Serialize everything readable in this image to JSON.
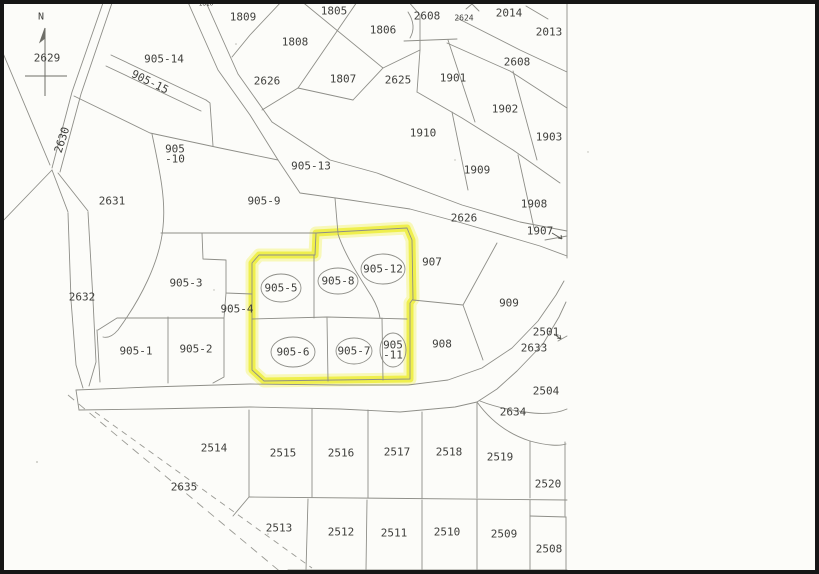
{
  "window": {
    "width": 819,
    "height": 574,
    "kind": "scanned cadastral parcel map"
  },
  "map": {
    "compass": {
      "label": "N"
    },
    "colors": {
      "paper": "#fcfcf9",
      "boundary_line": "#8e8e88",
      "label_text": "#3f3f3c",
      "highlight_yellow": "#eeee35",
      "frame_black": "#161616"
    },
    "highlighted_parcels": [
      "905-5",
      "905-6",
      "905-7",
      "905-8",
      "905-11",
      "905-12"
    ],
    "road_labels": [
      "2626",
      "2630",
      "2633",
      "2608",
      "2635"
    ],
    "labels": [
      {
        "t": "N",
        "x": 41,
        "y": 17,
        "fs": 10
      },
      {
        "t": "2629",
        "x": 47,
        "y": 58
      },
      {
        "t": "905-14",
        "x": 164,
        "y": 59
      },
      {
        "t": "905-15",
        "x": 150,
        "y": 82,
        "rot": 26
      },
      {
        "t": "2630",
        "x": 62,
        "y": 140,
        "rot": -72
      },
      {
        "t": "1810",
        "x": 206,
        "y": 4,
        "fs": 6
      },
      {
        "t": "1809",
        "x": 243,
        "y": 17
      },
      {
        "t": "1805",
        "x": 334,
        "y": 11
      },
      {
        "t": "1808",
        "x": 295,
        "y": 42
      },
      {
        "t": "1806",
        "x": 383,
        "y": 30
      },
      {
        "t": "1807",
        "x": 343,
        "y": 79
      },
      {
        "t": "2626",
        "x": 267,
        "y": 81
      },
      {
        "t": "2625",
        "x": 398,
        "y": 80
      },
      {
        "t": "2608",
        "x": 427,
        "y": 16
      },
      {
        "t": "2624",
        "x": 464,
        "y": 18,
        "fs": 8
      },
      {
        "t": "2014",
        "x": 509,
        "y": 13
      },
      {
        "t": "2013",
        "x": 549,
        "y": 32
      },
      {
        "t": "2608",
        "x": 517,
        "y": 62
      },
      {
        "t": "1901",
        "x": 453,
        "y": 78
      },
      {
        "t": "1902",
        "x": 505,
        "y": 109
      },
      {
        "t": "1910",
        "x": 423,
        "y": 133
      },
      {
        "t": "1903",
        "x": 549,
        "y": 137
      },
      {
        "t": "905-13",
        "x": 311,
        "y": 166
      },
      {
        "t": "1909",
        "x": 477,
        "y": 170
      },
      {
        "t": "905-10",
        "x": 175,
        "y": 154,
        "lines": [
          "905",
          "-10"
        ]
      },
      {
        "t": "905-9",
        "x": 264,
        "y": 201
      },
      {
        "t": "1908",
        "x": 534,
        "y": 204
      },
      {
        "t": "2626",
        "x": 464,
        "y": 218
      },
      {
        "t": "1907",
        "x": 540,
        "y": 231,
        "arrow": [
          552,
          233,
          562,
          239
        ]
      },
      {
        "t": "2631",
        "x": 112,
        "y": 201
      },
      {
        "t": "907",
        "x": 432,
        "y": 262
      },
      {
        "t": "2632",
        "x": 82,
        "y": 297
      },
      {
        "t": "905-3",
        "x": 186,
        "y": 283
      },
      {
        "t": "905-4",
        "x": 237,
        "y": 309
      },
      {
        "t": "909",
        "x": 509,
        "y": 303
      },
      {
        "t": "905-5",
        "x": 281,
        "y": 288,
        "ell": [
          20,
          14
        ]
      },
      {
        "t": "905-8",
        "x": 338,
        "y": 281,
        "ell": [
          20,
          13
        ]
      },
      {
        "t": "905-12",
        "x": 383,
        "y": 269,
        "ell": [
          22,
          15
        ]
      },
      {
        "t": "905-1",
        "x": 136,
        "y": 351
      },
      {
        "t": "905-2",
        "x": 196,
        "y": 349
      },
      {
        "t": "905-6",
        "x": 293,
        "y": 352,
        "ell": [
          22,
          15
        ]
      },
      {
        "t": "905-7",
        "x": 354,
        "y": 351,
        "ell": [
          18,
          13
        ]
      },
      {
        "t": "905-11",
        "x": 393,
        "y": 350,
        "lines": [
          "905",
          "-11"
        ],
        "ell": [
          13,
          17
        ]
      },
      {
        "t": "908",
        "x": 442,
        "y": 344
      },
      {
        "t": "2501",
        "x": 546,
        "y": 332,
        "arrow": [
          554,
          334,
          561,
          339
        ]
      },
      {
        "t": "2633",
        "x": 534,
        "y": 348
      },
      {
        "t": "2504",
        "x": 546,
        "y": 391
      },
      {
        "t": "2634",
        "x": 513,
        "y": 412
      },
      {
        "t": "2514",
        "x": 214,
        "y": 448
      },
      {
        "t": "2515",
        "x": 283,
        "y": 453
      },
      {
        "t": "2516",
        "x": 341,
        "y": 453
      },
      {
        "t": "2517",
        "x": 397,
        "y": 452
      },
      {
        "t": "2518",
        "x": 449,
        "y": 452
      },
      {
        "t": "2519",
        "x": 500,
        "y": 457
      },
      {
        "t": "2520",
        "x": 548,
        "y": 484
      },
      {
        "t": "2635",
        "x": 184,
        "y": 487
      },
      {
        "t": "2513",
        "x": 279,
        "y": 528
      },
      {
        "t": "2512",
        "x": 341,
        "y": 532
      },
      {
        "t": "2511",
        "x": 394,
        "y": 533
      },
      {
        "t": "2510",
        "x": 447,
        "y": 532
      },
      {
        "t": "2509",
        "x": 504,
        "y": 534
      },
      {
        "t": "2508",
        "x": 549,
        "y": 549
      }
    ]
  }
}
